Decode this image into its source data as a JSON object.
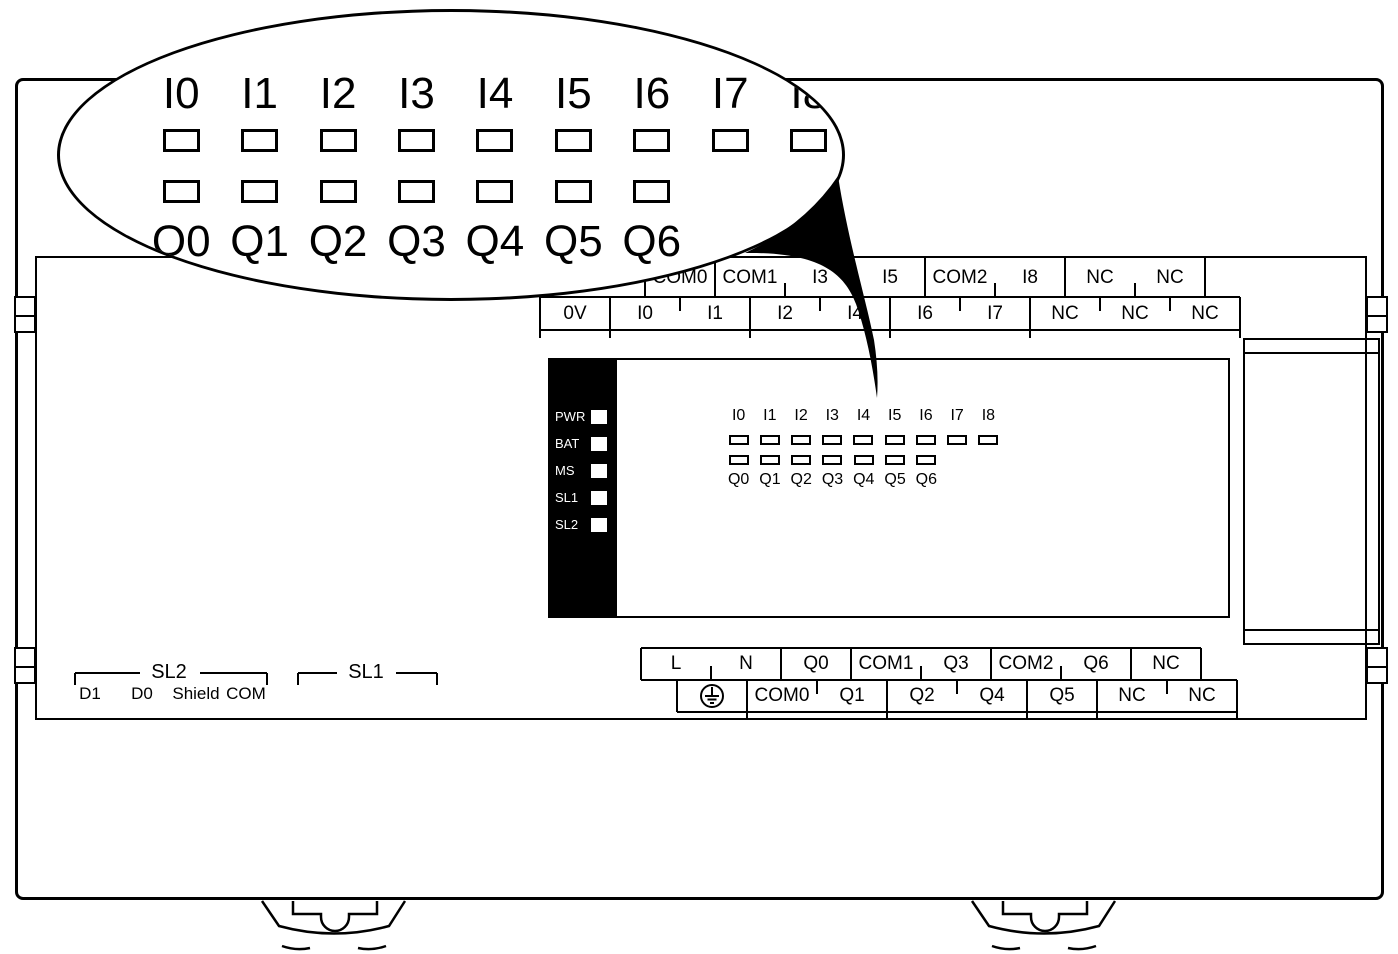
{
  "device": {
    "title": "PLC front panel diagram",
    "colors": {
      "line": "#000000",
      "background": "#ffffff",
      "panel": "#000000",
      "led_fill": "#ffffff"
    },
    "magnifier": {
      "input_labels": [
        "I0",
        "I1",
        "I2",
        "I3",
        "I4",
        "I5",
        "I6",
        "I7",
        "I8"
      ],
      "output_labels": [
        "Q0",
        "Q1",
        "Q2",
        "Q3",
        "Q4",
        "Q5",
        "Q6"
      ]
    },
    "top_strip": {
      "upper": [
        "COM0",
        "COM1",
        "I3",
        "I5",
        "COM2",
        "I8",
        "NC",
        "NC"
      ],
      "lower": [
        "0V",
        "I0",
        "I1",
        "I2",
        "I4",
        "I6",
        "I7",
        "NC",
        "NC",
        "NC"
      ]
    },
    "status_leds": [
      "PWR",
      "BAT",
      "MS",
      "SL1",
      "SL2"
    ],
    "matrix": {
      "inputs": [
        "I0",
        "I1",
        "I2",
        "I3",
        "I4",
        "I5",
        "I6",
        "I7",
        "I8"
      ],
      "outputs": [
        "Q0",
        "Q1",
        "Q2",
        "Q3",
        "Q4",
        "Q5",
        "Q6"
      ]
    },
    "bottom_strip": {
      "upper": [
        "L",
        "N",
        "Q0",
        "COM1",
        "Q3",
        "COM2",
        "Q6",
        "NC"
      ],
      "ground_icon": "earth-ground-icon",
      "lower": [
        "COM0",
        "Q1",
        "Q2",
        "Q4",
        "Q5",
        "NC",
        "NC"
      ]
    },
    "serial": {
      "sl2": "SL2",
      "sl2_pins": [
        "D1",
        "D0",
        "Shield",
        "COM"
      ],
      "sl1": "SL1"
    }
  }
}
